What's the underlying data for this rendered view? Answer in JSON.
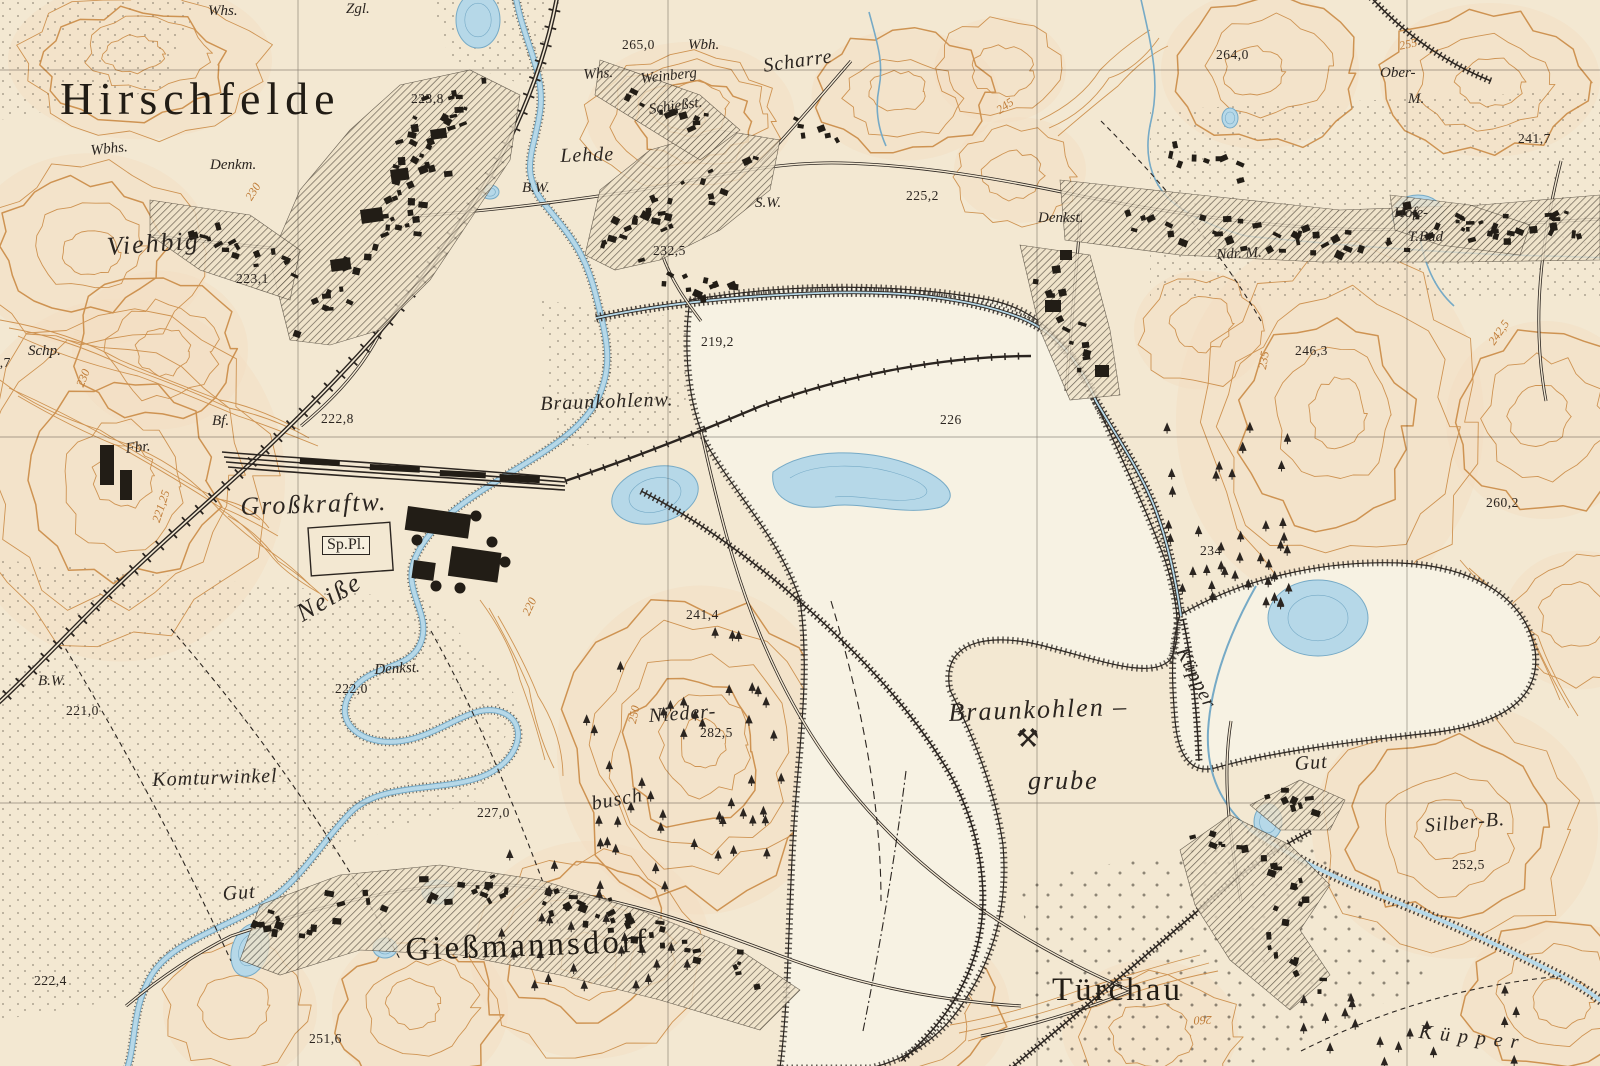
{
  "map": {
    "description": "Historic German topographic map sheet (Messtischblatt style) of Hirschfelde / Gießmannsdorf / Türchau with lignite mine",
    "colors": {
      "paper": "#f3e8d2",
      "pit_white": "#f7f2e3",
      "hill_tint": "#f4ddc1",
      "contour_orange": "#c8863e",
      "water_fill": "#b6d8e8",
      "water_line": "#76aac6",
      "ink": "#2b2520"
    },
    "grid": {
      "vertical_x": [
        298,
        668,
        1037,
        1407
      ],
      "horizontal_y": [
        70,
        437,
        803
      ]
    }
  },
  "labels": [
    {
      "n": "label-hirschfelde",
      "t": "Hirschfelde",
      "x": 60,
      "y": 76,
      "r": 0,
      "c": "town-xl"
    },
    {
      "n": "label-giessmannsdorf",
      "t": "Gießmannsdorf",
      "x": 405,
      "y": 934,
      "r": -2,
      "c": "town-lg"
    },
    {
      "n": "label-tuerchau",
      "t": "Türchau",
      "x": 1052,
      "y": 974,
      "r": 0,
      "c": "town-lg"
    },
    {
      "n": "label-viehbig",
      "t": "Viehbig",
      "x": 106,
      "y": 234,
      "r": -4,
      "c": "place-lg"
    },
    {
      "n": "label-neisse-river",
      "t": "Neiße",
      "x": 292,
      "y": 604,
      "r": -30,
      "c": "place-lg"
    },
    {
      "n": "label-lehde",
      "t": "Lehde",
      "x": 560,
      "y": 146,
      "r": -2,
      "c": "place"
    },
    {
      "n": "label-scharre",
      "t": "Scharre",
      "x": 762,
      "y": 56,
      "r": -8,
      "c": "place"
    },
    {
      "n": "label-komturwinkel",
      "t": "Komturwinkel",
      "x": 152,
      "y": 770,
      "r": -2,
      "c": "place"
    },
    {
      "n": "label-nieder",
      "t": "Nieder-",
      "x": 648,
      "y": 706,
      "r": -4,
      "c": "place"
    },
    {
      "n": "label-busch",
      "t": "busch",
      "x": 590,
      "y": 794,
      "r": -10,
      "c": "place"
    },
    {
      "n": "label-braunkohlen",
      "t": "Braunkohlen –",
      "x": 948,
      "y": 700,
      "r": -2,
      "c": "place-lg"
    },
    {
      "n": "label-grube",
      "t": "grube",
      "x": 1028,
      "y": 768,
      "r": 0,
      "c": "place-lg"
    },
    {
      "n": "label-braunkohlenwerk",
      "t": "Braunkohlenw.",
      "x": 540,
      "y": 394,
      "r": -2,
      "c": "place"
    },
    {
      "n": "label-grosskraftwerk",
      "t": "Großkraftw.",
      "x": 240,
      "y": 494,
      "r": -2,
      "c": "place-lg"
    },
    {
      "n": "label-kuepper-stream",
      "t": "Küpper",
      "x": 1190,
      "y": 644,
      "r": 63,
      "c": "place"
    },
    {
      "n": "label-kuepper-bottom",
      "t": "Küpper",
      "x": 1420,
      "y": 1022,
      "r": 6,
      "c": "place spread"
    },
    {
      "n": "label-ober",
      "t": "Ober-",
      "x": 1380,
      "y": 66,
      "r": 0,
      "c": "abbr"
    },
    {
      "n": "label-ober-m",
      "t": "M.",
      "x": 1408,
      "y": 92,
      "r": 0,
      "c": "abbr"
    },
    {
      "n": "label-hofe",
      "t": "Hofe-",
      "x": 1394,
      "y": 206,
      "r": 0,
      "c": "abbr"
    },
    {
      "n": "label-t-bad",
      "t": "T.Bad",
      "x": 1408,
      "y": 230,
      "r": 0,
      "c": "abbr"
    },
    {
      "n": "label-ndr-m",
      "t": "Ndr. M.",
      "x": 1216,
      "y": 248,
      "r": -3,
      "c": "abbr"
    },
    {
      "n": "label-silber-b",
      "t": "Silber-B.",
      "x": 1424,
      "y": 816,
      "r": -5,
      "c": "place"
    },
    {
      "n": "label-gut-west",
      "t": "Gut",
      "x": 222,
      "y": 884,
      "r": -4,
      "c": "place"
    },
    {
      "n": "label-gut-east",
      "t": "Gut",
      "x": 1294,
      "y": 754,
      "r": -4,
      "c": "place"
    },
    {
      "n": "label-whs-nw",
      "t": "Whs.",
      "x": 208,
      "y": 4,
      "r": 0,
      "c": "abbr"
    },
    {
      "n": "label-zgl",
      "t": "Zgl.",
      "x": 346,
      "y": 2,
      "r": 0,
      "c": "abbr"
    },
    {
      "n": "label-wbhs",
      "t": "Wbhs.",
      "x": 90,
      "y": 144,
      "r": -6,
      "c": "abbr"
    },
    {
      "n": "label-denkm",
      "t": "Denkm.",
      "x": 210,
      "y": 158,
      "r": 0,
      "c": "abbr"
    },
    {
      "n": "label-schp",
      "t": "Schp.",
      "x": 28,
      "y": 344,
      "r": 0,
      "c": "abbr"
    },
    {
      "n": "label-bf",
      "t": "Bf.",
      "x": 212,
      "y": 414,
      "r": 0,
      "c": "abbr"
    },
    {
      "n": "label-fbr",
      "t": "Fbr.",
      "x": 125,
      "y": 442,
      "r": -6,
      "c": "abbr"
    },
    {
      "n": "label-bw-lehde",
      "t": "B.W.",
      "x": 522,
      "y": 181,
      "r": 0,
      "c": "abbr"
    },
    {
      "n": "label-sw",
      "t": "S.W.",
      "x": 755,
      "y": 196,
      "r": 0,
      "c": "abbr"
    },
    {
      "n": "label-whs-weinberg",
      "t": "Whs.",
      "x": 583,
      "y": 68,
      "r": -4,
      "c": "abbr"
    },
    {
      "n": "label-weinberg",
      "t": "Weinberg",
      "x": 640,
      "y": 72,
      "r": -6,
      "c": "abbr"
    },
    {
      "n": "label-schiessstand",
      "t": "Schießst.",
      "x": 648,
      "y": 103,
      "r": -8,
      "c": "abbr"
    },
    {
      "n": "label-wbh",
      "t": "Wbh.",
      "x": 688,
      "y": 38,
      "r": 0,
      "c": "abbr"
    },
    {
      "n": "label-denkst-east",
      "t": "Denkst.",
      "x": 1038,
      "y": 211,
      "r": 0,
      "c": "abbr"
    },
    {
      "n": "label-denkst-south",
      "t": "Denkst.",
      "x": 374,
      "y": 663,
      "r": -3,
      "c": "abbr"
    },
    {
      "n": "label-bw-sw",
      "t": "B.W.",
      "x": 38,
      "y": 674,
      "r": 0,
      "c": "abbr"
    },
    {
      "n": "label-sportplatz",
      "t": "Sp.Pl.",
      "x": 322,
      "y": 536,
      "r": 0,
      "c": "box"
    },
    {
      "n": "label-mine-symbol",
      "t": "⚒",
      "x": 1016,
      "y": 726,
      "r": 0,
      "c": "glyph"
    },
    {
      "n": "elev-223-1",
      "t": "223,1",
      "x": 236,
      "y": 272,
      "r": 0,
      "c": "spot"
    },
    {
      "n": "elev-223-8",
      "t": "223,8",
      "x": 411,
      "y": 92,
      "r": 0,
      "c": "spot"
    },
    {
      "n": "elev-265-0",
      "t": "265,0",
      "x": 622,
      "y": 38,
      "r": 0,
      "c": "spot"
    },
    {
      "n": "elev-232-5",
      "t": "232,5",
      "x": 653,
      "y": 244,
      "r": 0,
      "c": "spot"
    },
    {
      "n": "elev-225-2",
      "t": "225,2",
      "x": 906,
      "y": 189,
      "r": 0,
      "c": "spot"
    },
    {
      "n": "elev-219-2",
      "t": "219,2",
      "x": 701,
      "y": 335,
      "r": 0,
      "c": "spot"
    },
    {
      "n": "elev-226",
      "t": "226",
      "x": 940,
      "y": 413,
      "r": 0,
      "c": "spot"
    },
    {
      "n": "elev-222-8",
      "t": "222,8",
      "x": 321,
      "y": 412,
      "r": 0,
      "c": "spot"
    },
    {
      "n": "elev-244-7",
      "t": "244,7",
      "x": -22,
      "y": 356,
      "r": 0,
      "c": "spot"
    },
    {
      "n": "elev-264-0",
      "t": "264,0",
      "x": 1216,
      "y": 48,
      "r": 0,
      "c": "spot"
    },
    {
      "n": "elev-241-7",
      "t": "241,7",
      "x": 1518,
      "y": 132,
      "r": 0,
      "c": "spot"
    },
    {
      "n": "elev-246-3",
      "t": "246,3",
      "x": 1295,
      "y": 344,
      "r": 0,
      "c": "spot"
    },
    {
      "n": "elev-260-2",
      "t": "260,2",
      "x": 1486,
      "y": 496,
      "r": 0,
      "c": "spot"
    },
    {
      "n": "elev-234",
      "t": "234",
      "x": 1200,
      "y": 544,
      "r": 0,
      "c": "spot"
    },
    {
      "n": "elev-241-4",
      "t": "241,4",
      "x": 686,
      "y": 608,
      "r": 0,
      "c": "spot"
    },
    {
      "n": "elev-282-5",
      "t": "282,5",
      "x": 700,
      "y": 726,
      "r": 0,
      "c": "spot"
    },
    {
      "n": "elev-222-0",
      "t": "222,0",
      "x": 335,
      "y": 682,
      "r": 0,
      "c": "spot"
    },
    {
      "n": "elev-221-0",
      "t": "221,0",
      "x": 66,
      "y": 704,
      "r": 0,
      "c": "spot"
    },
    {
      "n": "elev-227-0",
      "t": "227,0",
      "x": 477,
      "y": 806,
      "r": 0,
      "c": "spot"
    },
    {
      "n": "elev-251-6",
      "t": "251,6",
      "x": 309,
      "y": 1032,
      "r": 0,
      "c": "spot"
    },
    {
      "n": "elev-222-4",
      "t": "222,4",
      "x": 34,
      "y": 974,
      "r": 0,
      "c": "spot"
    },
    {
      "n": "elev-252-5",
      "t": "252,5",
      "x": 1452,
      "y": 858,
      "r": 0,
      "c": "spot"
    },
    {
      "n": "contour-230-a",
      "t": "230",
      "x": 243,
      "y": 196,
      "r": -58,
      "c": "contour"
    },
    {
      "n": "contour-245",
      "t": "245",
      "x": 994,
      "y": 106,
      "r": -35,
      "c": "contour"
    },
    {
      "n": "contour-255",
      "t": "255",
      "x": 1398,
      "y": 40,
      "r": -12,
      "c": "contour"
    },
    {
      "n": "contour-230-b",
      "t": "230",
      "x": 74,
      "y": 384,
      "r": -68,
      "c": "contour"
    },
    {
      "n": "contour-221-25",
      "t": "221,25",
      "x": 150,
      "y": 520,
      "r": -72,
      "c": "contour"
    },
    {
      "n": "contour-220",
      "t": "220",
      "x": 520,
      "y": 612,
      "r": -65,
      "c": "contour"
    },
    {
      "n": "contour-250",
      "t": "250",
      "x": 626,
      "y": 722,
      "r": -78,
      "c": "contour"
    },
    {
      "n": "contour-260",
      "t": "260",
      "x": 1212,
      "y": 1026,
      "r": 178,
      "c": "contour"
    },
    {
      "n": "contour-235",
      "t": "235",
      "x": 1256,
      "y": 368,
      "r": -80,
      "c": "contour"
    },
    {
      "n": "contour-242-5",
      "t": "242,5",
      "x": 1486,
      "y": 340,
      "r": -55,
      "c": "contour"
    }
  ]
}
